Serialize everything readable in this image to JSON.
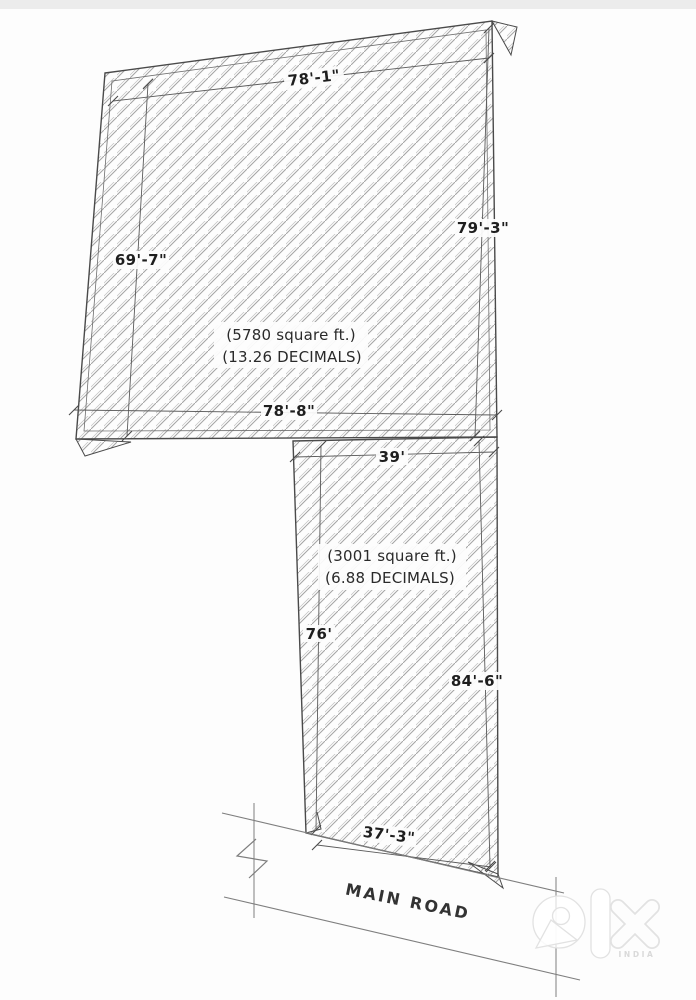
{
  "page": {
    "background": "#fdfdfd",
    "top_band_color": "#ececec"
  },
  "diagram": {
    "type": "land-survey-site-plan",
    "hatch_color": "#a3a3a3",
    "boundary_color": "#4a4a4a",
    "parcels": [
      {
        "name": "upper-plot",
        "area": "(5780 square ft.)",
        "decimals": "(13.26 DECIMALS)",
        "dimensions": {
          "top": "78'-1\"",
          "left": "69'-7\"",
          "right": "79'-3\"",
          "bottom": "78'-8\""
        }
      },
      {
        "name": "lower-plot",
        "area": "(3001 square ft.)",
        "decimals": "(6.88 DECIMALS)",
        "dimensions": {
          "top": "39'",
          "left": "76'",
          "right": "84'-6\"",
          "bottom": "37'-3\""
        }
      }
    ],
    "road_label": "MAIN ROAD"
  },
  "watermark": {
    "brand_icon": "olx-logo-icon",
    "country": "INDIA"
  }
}
